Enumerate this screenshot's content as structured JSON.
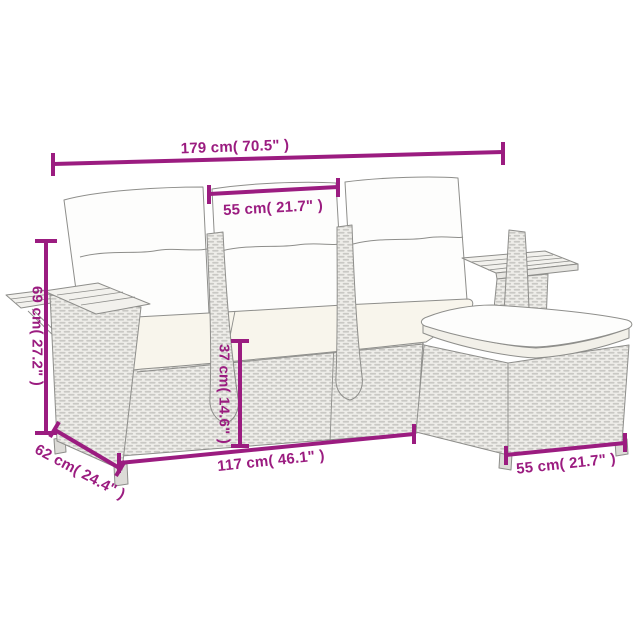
{
  "style": {
    "dimension_color": "#9b1c80",
    "sketch_outline_color": "#8e8e8b",
    "rattan_dash_color": "#c9c8c4",
    "rattan_fill_color": "#eeede9",
    "pillow_color": "#fdfdfc",
    "seat_cushion_color": "#f8f5ec",
    "wood_slat_color": "#f2f1ed",
    "background": "#ffffff"
  },
  "dimensions": {
    "overall_width": {
      "label": "179 cm( 70.5\" )"
    },
    "seat_width": {
      "label": "55 cm( 21.7\" )"
    },
    "overall_height": {
      "label": "69 cm( 27.2\" )"
    },
    "seat_height": {
      "label": "37 cm( 14.6\" )"
    },
    "front_length": {
      "label": "117 cm( 46.1\" )"
    },
    "depth": {
      "label": "62 cm( 24.4\" )"
    },
    "footstool_width": {
      "label": "55 cm( 21.7\" )"
    }
  }
}
